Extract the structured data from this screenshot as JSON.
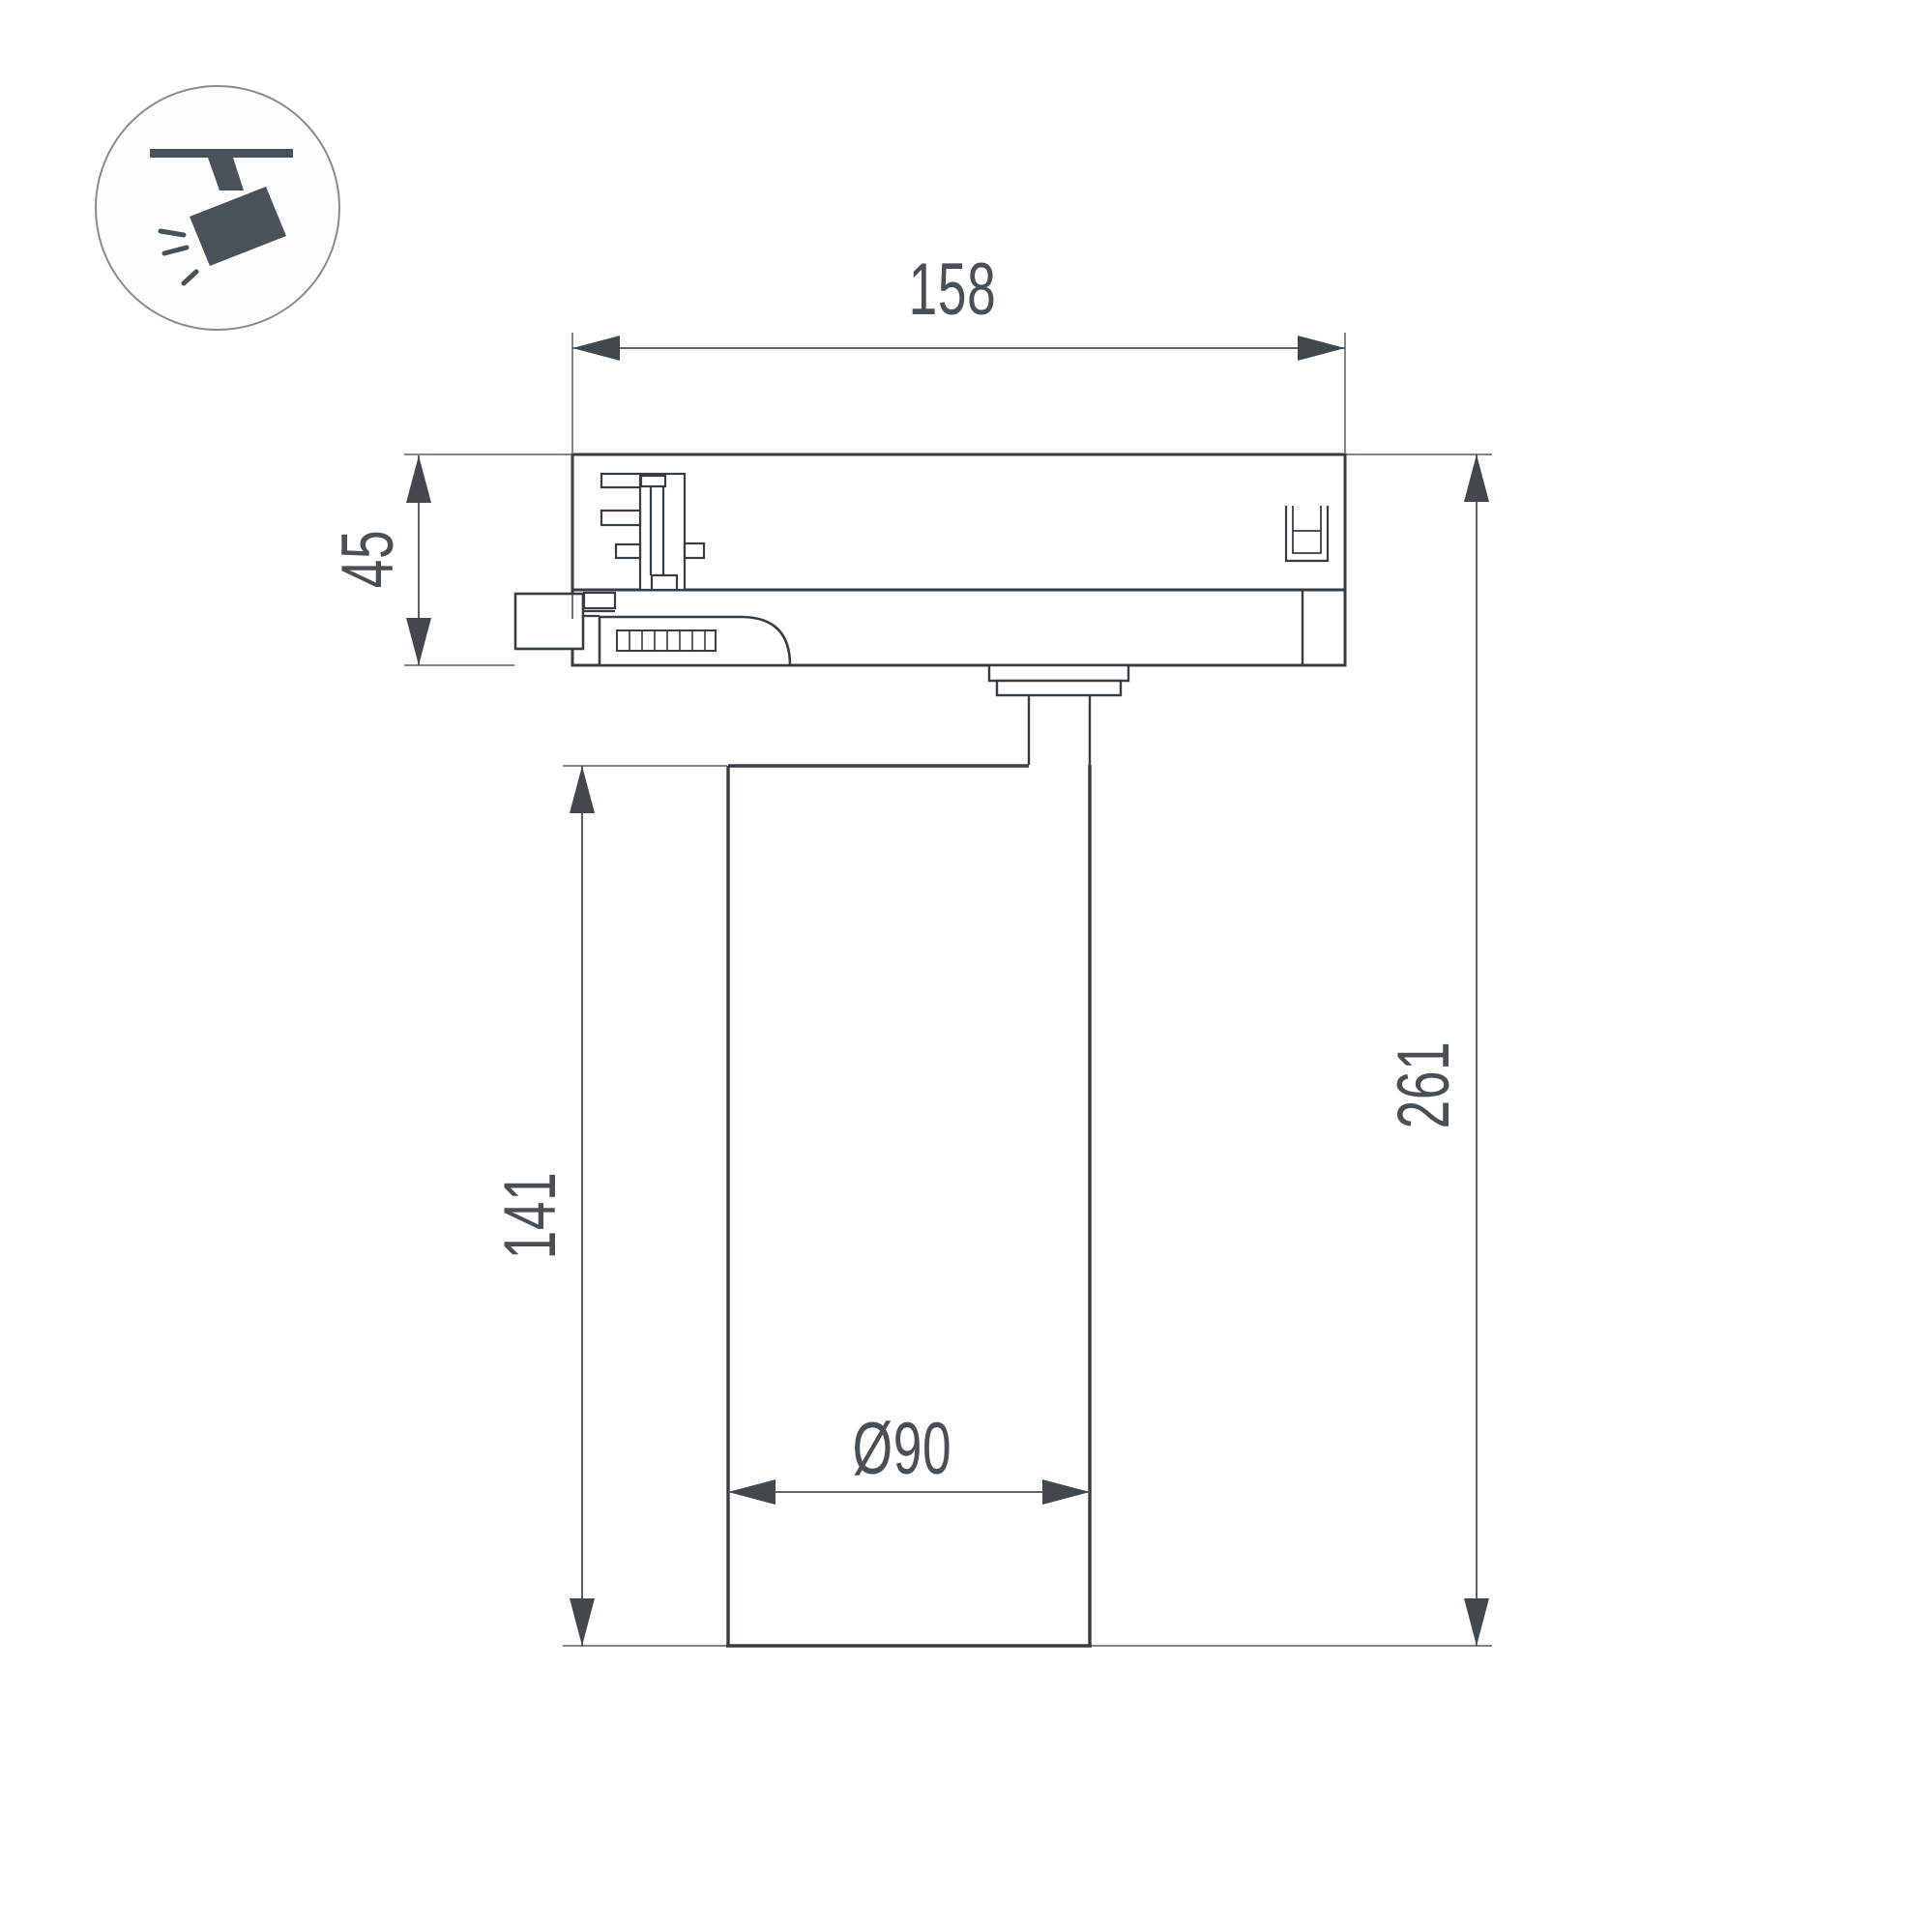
{
  "drawing": {
    "title": "track-spotlight-dimension-drawing",
    "labels": {
      "width": "158",
      "adapter_height": "45",
      "body_height": "141",
      "total_height": "261",
      "diameter": "Ø90"
    },
    "colors": {
      "object_line": "#383d42",
      "dimension_line": "#4b5055",
      "icon_fill": "#49525a",
      "background": "#ffffff"
    },
    "icon": "track-spotlight-icon"
  }
}
